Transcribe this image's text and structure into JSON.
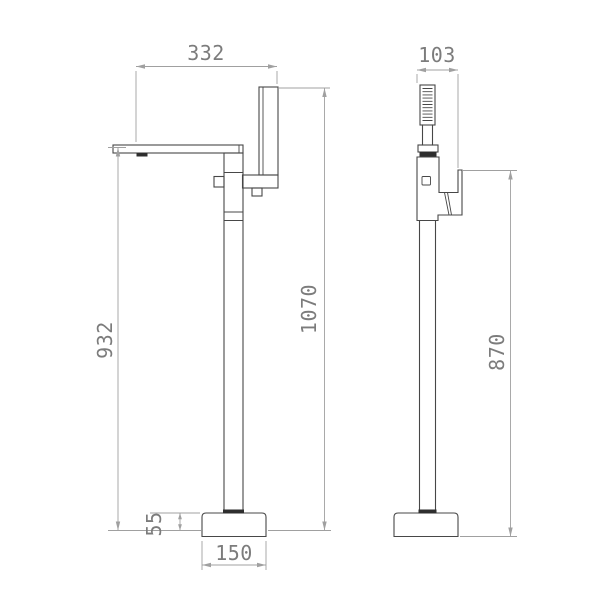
{
  "drawing": {
    "description": "Technical dimension drawing of a freestanding bathtub mixer tap with hand shower, front and side elevations",
    "dimension_labels": {
      "spout_reach": "332",
      "hand_shower_width": "103",
      "overall_height": "1070",
      "spout_height": "932",
      "hand_shower_handle_height": "870",
      "base_height": "55",
      "base_width": "150"
    },
    "colors": {
      "object_line": "#474747",
      "dark_fill": "#2e2e2e",
      "dimension_line": "#a0a0a0",
      "dimension_text": "#7c7c7c",
      "background": "#ffffff"
    }
  }
}
